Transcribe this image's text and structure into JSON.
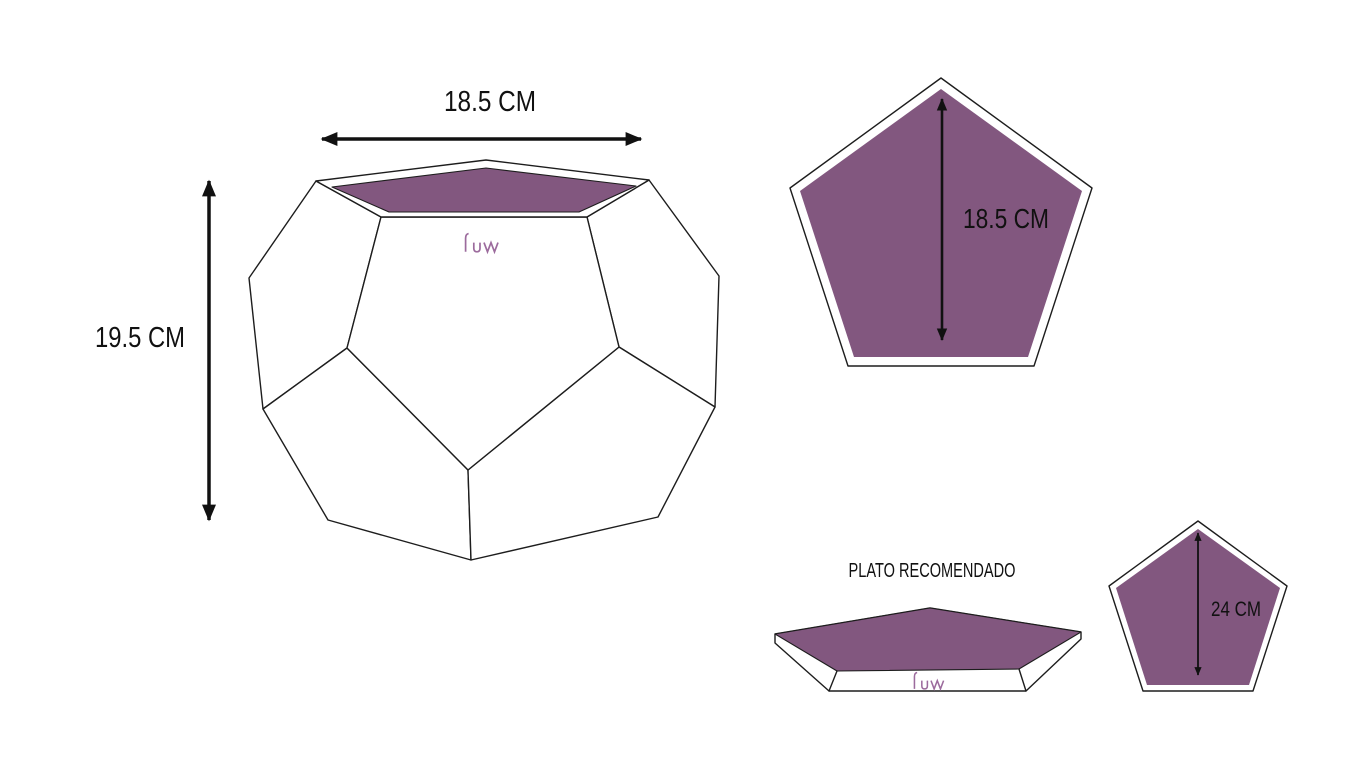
{
  "colors": {
    "purple": "#82577F",
    "logo": "#9C6B9D",
    "ink": "#1D1D1D"
  },
  "planter": {
    "width_label": "18.5 CM",
    "height_label": "19.5 CM",
    "brand": "LUVA"
  },
  "top_view": {
    "diameter_label": "18.5 CM"
  },
  "plate": {
    "title": "PLATO RECOMENDADO",
    "diameter_label": "24 CM",
    "brand": "LUVA"
  }
}
